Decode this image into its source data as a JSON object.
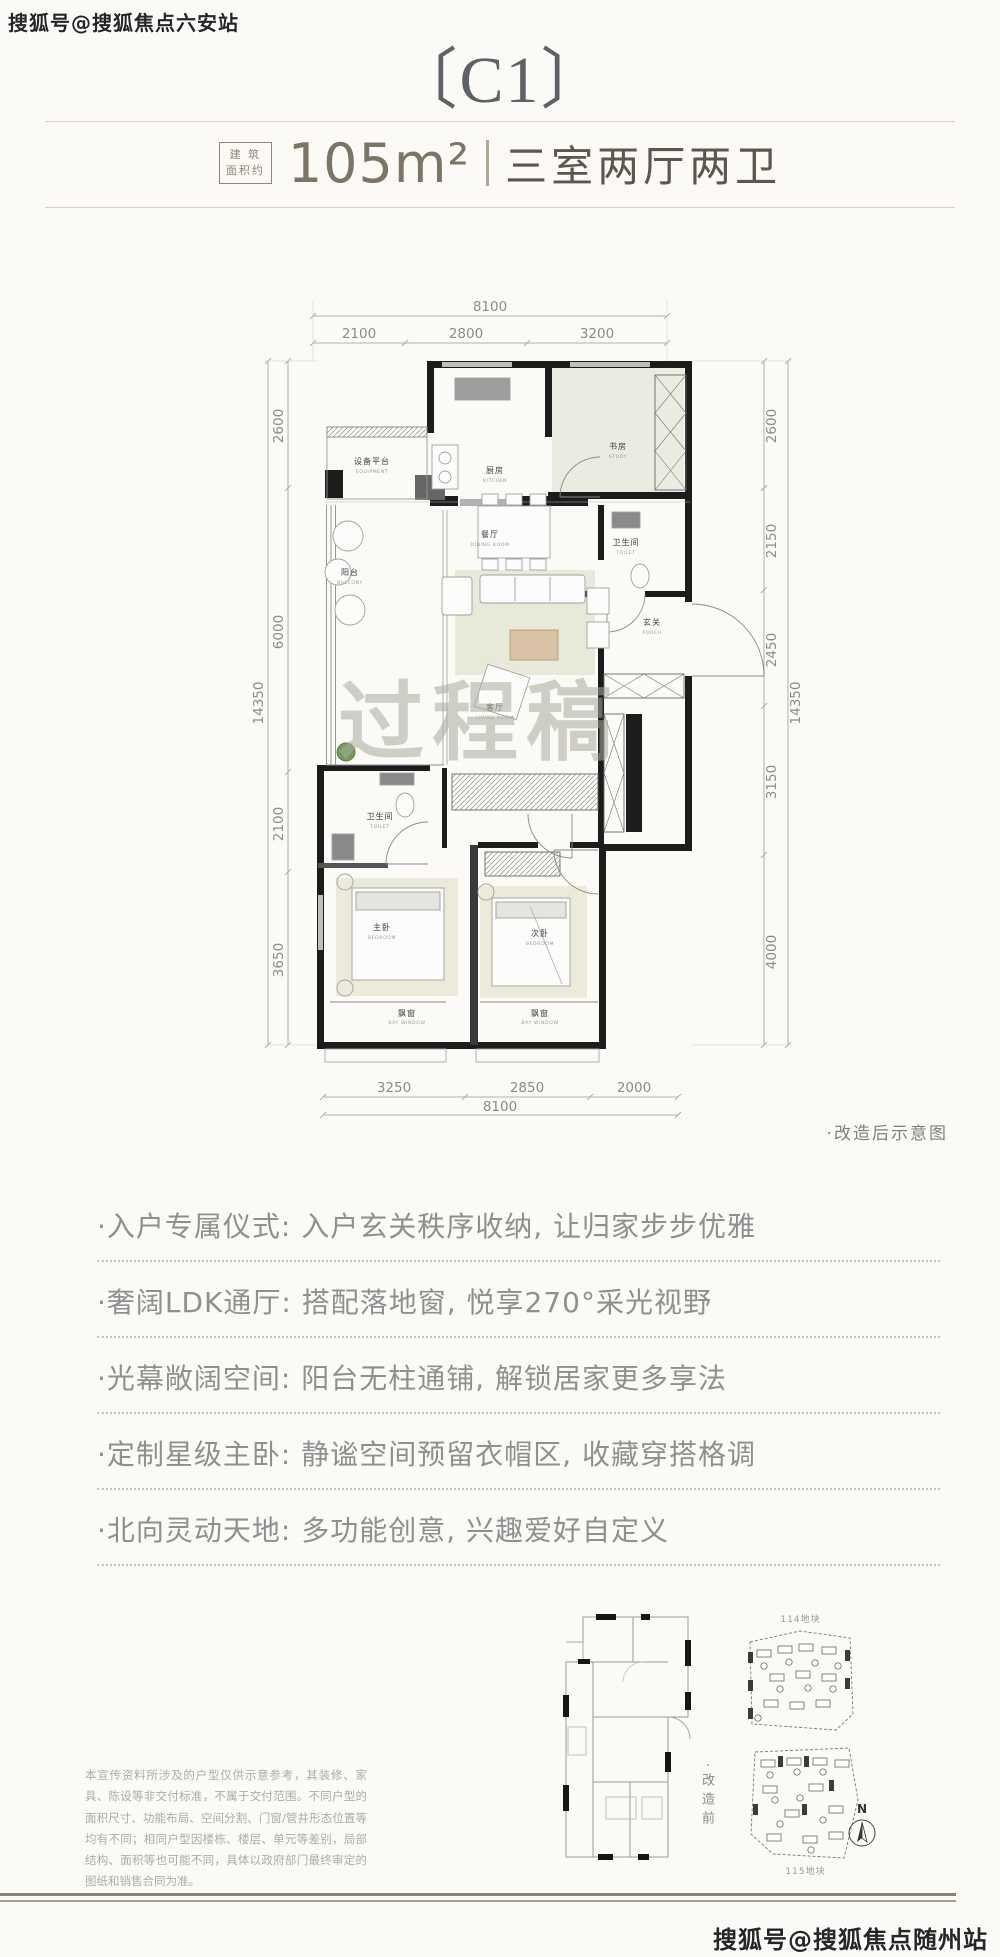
{
  "watermark_top": "搜狐号@搜狐焦点六安站",
  "watermark_bottom": "搜狐号@搜狐焦点随州站",
  "header": {
    "title": "〔C1〕",
    "area_tag_line1": "建 筑",
    "area_tag_line2": "面积约",
    "area_value": "105m²",
    "layout": "三室两厅两卫"
  },
  "floorplan": {
    "watermark": "过程稿",
    "caption": "·改造后示意图",
    "dims": {
      "top_total": "8100",
      "top_segments": [
        "2100",
        "2800",
        "3200"
      ],
      "bottom_segments": [
        "3250",
        "2850",
        "2000"
      ],
      "bottom_total": "8100",
      "left_segments": [
        "2600",
        "6000",
        "2100",
        "3650"
      ],
      "left_total": "14350",
      "right_segments": [
        "2600",
        "2150",
        "2450",
        "3150",
        "4000"
      ],
      "right_total": "14350"
    },
    "rooms": {
      "equipment": {
        "cn": "设备平台",
        "en": "EQUIPMENT"
      },
      "kitchen": {
        "cn": "厨房",
        "en": "KITCHEN"
      },
      "study": {
        "cn": "书房",
        "en": "STUDY"
      },
      "toilet_a": {
        "cn": "卫生间",
        "en": "TOILET"
      },
      "porch": {
        "cn": "玄关",
        "en": "PORCH"
      },
      "dining": {
        "cn": "餐厅",
        "en": "DINING ROOM"
      },
      "balcony": {
        "cn": "阳台",
        "en": "BALCONY"
      },
      "living": {
        "cn": "客厅",
        "en": "LIVING ROOM"
      },
      "toilet_b": {
        "cn": "卫生间",
        "en": "TOILET"
      },
      "master": {
        "cn": "主卧",
        "en": "BEDROOM"
      },
      "second": {
        "cn": "次卧",
        "en": "BEDROOM"
      },
      "bay_left": {
        "cn": "飘窗",
        "en": "BAY WINDOW"
      },
      "bay_right": {
        "cn": "飘窗",
        "en": "BAY WINDOW"
      }
    }
  },
  "features": [
    "·入户专属仪式: 入户玄关秩序收纳, 让归家步步优雅",
    "·奢阔LDK通厅: 搭配落地窗, 悦享270°采光视野",
    "·光幕敞阔空间: 阳台无柱通铺, 解锁居家更多享法",
    "·定制星级主卧: 静谧空间预留衣帽区, 收藏穿搭格调",
    "·北向灵动天地: 多功能创意, 兴趣爱好自定义"
  ],
  "footer": {
    "disclaimer": "本宣传资料所涉及的户型仅供示意参考，其装修、家具、陈设等非交付标准，不属于交付范围。不同户型的面积尺寸、功能布局、空间分割、门窗/管井形态位置等均有不同；相同户型因楼栋、楼层、单元等差别，局部结构、面积等也可能不同，具体以政府部门最终审定的图纸和销售合同为准。",
    "before_caption": "·改造前",
    "site_top_label": "114地块",
    "site_bottom_label": "115地块",
    "compass": "N"
  },
  "colors": {
    "accent_tan": "#a99e8c",
    "wall_black": "#1c1c1c",
    "text_gray": "#8f8f8f",
    "title_gray": "#5e6266"
  }
}
